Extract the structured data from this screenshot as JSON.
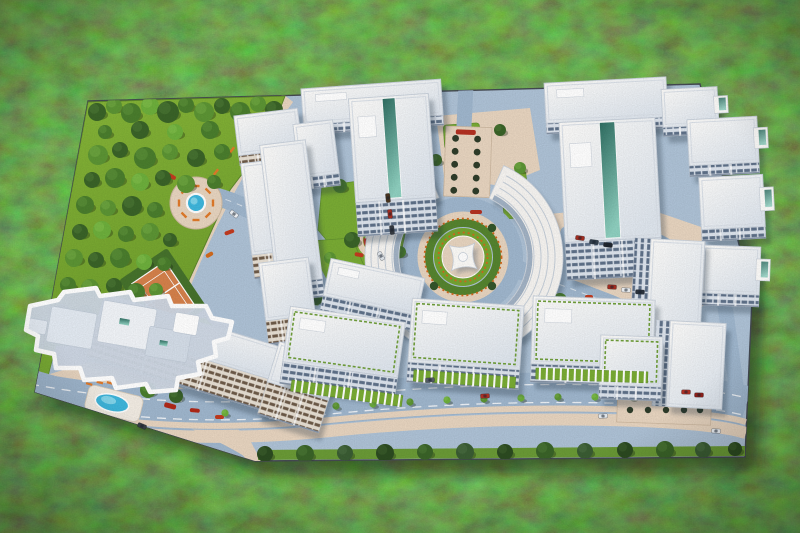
{
  "meta": {
    "title": "Aerial photo of an architectural scale model of a residential complex standing on grass",
    "alt": "Top-down photo of a miniature maquette: white apartment blocks around a star-monument roundabout, park with model trees, tennis court, pools, boulevard with cars; one building outlined in white"
  },
  "palette": {
    "base": "#aec2d6",
    "road": "#9fb6cd",
    "tan": "#e7d4bf",
    "tanDark": "#d9c5ae",
    "turf1": "#86b538",
    "turf2": "#6f9e2c",
    "green": "#79ab34",
    "white": "#f6f4f1",
    "roofEdge": "#c9d1db",
    "pool": "#3fb6dc",
    "orange": "#d2691e",
    "red": "#b33122",
    "edge": "#454a52",
    "treeCols": [
      "#2c4b21",
      "#3a6328",
      "#4a7d2d",
      "#5c9434",
      "#6daf3c",
      "#3a5c33"
    ],
    "treeHi": [
      "#3f6330",
      "#4f7d38",
      "#62973d",
      "#76ad46",
      "#86c14e",
      "#4e7145"
    ]
  },
  "base": {
    "path": "M 88,101 L 700,84 L 752,298 L 745,457 L 255,461 L 35,392 Z"
  },
  "park": {
    "points": "88,102 285,96 268,140 230,190 205,245 180,300 150,335 118,346 43,345",
    "trees": [
      [
        97,
        112,
        9,
        1
      ],
      [
        114,
        106,
        8,
        3
      ],
      [
        131,
        113,
        10,
        2
      ],
      [
        150,
        106,
        9,
        4
      ],
      [
        168,
        112,
        11,
        1
      ],
      [
        186,
        105,
        8,
        2
      ],
      [
        204,
        112,
        10,
        3
      ],
      [
        222,
        106,
        8,
        1
      ],
      [
        240,
        112,
        10,
        2
      ],
      [
        258,
        104,
        8,
        3
      ],
      [
        274,
        110,
        9,
        1
      ],
      [
        105,
        132,
        7,
        2
      ],
      [
        140,
        130,
        9,
        1
      ],
      [
        175,
        132,
        8,
        4
      ],
      [
        210,
        130,
        9,
        2
      ],
      [
        245,
        128,
        8,
        1
      ],
      [
        264,
        132,
        7,
        3
      ],
      [
        98,
        155,
        10,
        3
      ],
      [
        120,
        150,
        8,
        1
      ],
      [
        145,
        158,
        11,
        2
      ],
      [
        170,
        152,
        8,
        3
      ],
      [
        196,
        158,
        9,
        1
      ],
      [
        222,
        152,
        8,
        2
      ],
      [
        246,
        152,
        9,
        4
      ],
      [
        92,
        180,
        8,
        1
      ],
      [
        115,
        178,
        10,
        2
      ],
      [
        140,
        182,
        9,
        4
      ],
      [
        163,
        178,
        8,
        1
      ],
      [
        186,
        184,
        9,
        3
      ],
      [
        214,
        182,
        7,
        2
      ],
      [
        85,
        205,
        9,
        2
      ],
      [
        108,
        208,
        8,
        3
      ],
      [
        132,
        206,
        10,
        1
      ],
      [
        155,
        210,
        8,
        2
      ],
      [
        80,
        232,
        8,
        1
      ],
      [
        102,
        230,
        9,
        4
      ],
      [
        126,
        234,
        8,
        2
      ],
      [
        150,
        232,
        9,
        3
      ],
      [
        170,
        240,
        7,
        1
      ],
      [
        74,
        258,
        9,
        3
      ],
      [
        96,
        260,
        8,
        1
      ],
      [
        120,
        258,
        10,
        2
      ],
      [
        144,
        262,
        8,
        4
      ],
      [
        164,
        264,
        7,
        2
      ],
      [
        68,
        285,
        8,
        2
      ],
      [
        90,
        288,
        9,
        3
      ],
      [
        114,
        286,
        8,
        1
      ],
      [
        136,
        292,
        9,
        2
      ],
      [
        156,
        290,
        7,
        3
      ],
      [
        62,
        312,
        8,
        1
      ],
      [
        84,
        314,
        9,
        2
      ],
      [
        108,
        312,
        8,
        4
      ],
      [
        130,
        318,
        8,
        1
      ],
      [
        58,
        336,
        7,
        3
      ],
      [
        80,
        338,
        8,
        1
      ],
      [
        102,
        336,
        8,
        2
      ],
      [
        122,
        340,
        7,
        3
      ]
    ]
  },
  "roads": {
    "boulevard": "M 30,392 C 140,412 230,414 330,404 C 430,394 540,390 640,394 C 690,396 726,400 746,406",
    "paths": [
      {
        "d": "M 214,196 C 252,206 284,228 304,258 C 322,284 334,320 348,356 L 360,392",
        "w": 18
      },
      {
        "d": "M 514,268 C 548,280 580,292 606,302 C 636,313 658,332 670,356 L 678,386",
        "w": 18
      },
      {
        "d": "M 466,86 L 464,126",
        "w": 15
      },
      {
        "d": "M 414,268 C 396,276 378,294 366,318 C 360,330 356,342 352,352",
        "w": 13
      },
      {
        "d": "M 724,300 C 730,340 734,368 738,402",
        "w": 15
      },
      {
        "d": "M 22,378 C 68,390 118,408 158,426 C 190,440 216,452 236,464",
        "w": 22
      },
      {
        "d": "M 566,232 C 602,224 644,228 670,246 C 692,260 696,284 680,298 C 660,314 618,316 594,306 C 570,296 560,282 562,262 C 563,248 564,240 566,232",
        "w": 11
      }
    ]
  },
  "sidewalks": {
    "cornerTan": "30,380 90,362 150,372 205,400 250,440 262,463 120,463 28,412",
    "courtyardTan": "548,214 640,206 704,228 710,300 686,320 600,326 560,304 544,258",
    "topTan": "436,116 530,108 540,170 500,186 444,176",
    "walk": "M 288,98 C 242,158 208,224 182,290 C 172,314 162,328 150,340"
  },
  "greens": [
    {
      "type": "poly",
      "pts": "322,186 396,176 410,210 400,258 350,268 318,230"
    },
    {
      "type": "poly",
      "pts": "296,242 352,238 368,275 352,308 306,304 288,272"
    },
    {
      "type": "poly",
      "pts": "556,300 598,294 612,318 592,334 558,330"
    },
    {
      "type": "rect",
      "x": 640,
      "y": 326,
      "w": 54,
      "h": 22,
      "rot": 3
    },
    {
      "type": "rect",
      "x": 444,
      "y": 124,
      "w": 36,
      "h": 24,
      "rot": -4
    },
    {
      "type": "rect",
      "x": 502,
      "y": 172,
      "w": 26,
      "h": 46,
      "rot": -6
    },
    {
      "type": "rect",
      "x": 526,
      "y": 206,
      "w": 22,
      "h": 34,
      "rot": -10
    },
    {
      "type": "poly",
      "pts": "43,345 56,345 44,392 35,392"
    },
    {
      "type": "poly",
      "pts": "118,330 205,318 230,345 150,360 95,360"
    }
  ],
  "arcades": [
    {
      "x": 292,
      "y": 380,
      "w": 112,
      "h": 11,
      "rot": 8
    },
    {
      "x": 414,
      "y": 370,
      "w": 102,
      "h": 11,
      "rot": 4
    },
    {
      "x": 536,
      "y": 368,
      "w": 112,
      "h": 11,
      "rot": 2
    }
  ],
  "buildings": [
    {
      "x": 302,
      "y": 84,
      "w": 140,
      "h": 36,
      "rot": -4,
      "fh": 10,
      "p": "fa"
    },
    {
      "x": 545,
      "y": 80,
      "w": 122,
      "h": 40,
      "rot": -3,
      "fh": 11,
      "p": "fa"
    },
    {
      "x": 662,
      "y": 88,
      "w": 56,
      "h": 38,
      "rot": -3,
      "fh": 9,
      "p": "fa",
      "balc": 1
    },
    {
      "x": 236,
      "y": 112,
      "w": 64,
      "h": 40,
      "rot": -7,
      "fh": 10,
      "p": "fb"
    },
    {
      "x": 296,
      "y": 122,
      "w": 40,
      "h": 54,
      "rot": -7,
      "fh": 12,
      "p": "fa"
    },
    {
      "x": 688,
      "y": 118,
      "w": 70,
      "h": 46,
      "rot": -3,
      "fh": 11,
      "p": "fa",
      "balc": 1
    },
    {
      "x": 352,
      "y": 96,
      "w": 80,
      "h": 104,
      "rot": -4,
      "fh": 34,
      "p": "fa",
      "glass": 1
    },
    {
      "x": 562,
      "y": 120,
      "w": 96,
      "h": 120,
      "rot": -3,
      "fh": 38,
      "p": "fa",
      "glass": 1
    },
    {
      "x": 246,
      "y": 160,
      "w": 56,
      "h": 92,
      "rot": -7,
      "fh": 24,
      "p": "fb"
    },
    {
      "x": 268,
      "y": 142,
      "w": 46,
      "h": 140,
      "rot": -7,
      "fh": 18,
      "p": "fa"
    },
    {
      "x": 700,
      "y": 176,
      "w": 64,
      "h": 52,
      "rot": -3,
      "fh": 12,
      "p": "fa",
      "balc": 1
    },
    {
      "x": 702,
      "y": 246,
      "w": 58,
      "h": 48,
      "rot": 2,
      "fh": 12,
      "p": "fa",
      "balc": 1
    },
    {
      "x": 648,
      "y": 240,
      "w": 54,
      "h": 112,
      "rot": 3,
      "fh": 16,
      "p": "fv",
      "fside": "left"
    },
    {
      "x": 262,
      "y": 260,
      "w": 50,
      "h": 58,
      "rot": -7,
      "fh": 24,
      "p": "fb"
    },
    {
      "x": 326,
      "y": 268,
      "w": 96,
      "h": 38,
      "rot": 12,
      "fh": 16,
      "p": "fa"
    },
    {
      "x": 96,
      "y": 322,
      "w": 200,
      "h": 34,
      "rot": 17,
      "fh": 32,
      "p": "fb"
    },
    {
      "x": 272,
      "y": 350,
      "w": 64,
      "h": 42,
      "rot": 17,
      "fh": 34,
      "p": "fb"
    },
    {
      "x": 286,
      "y": 314,
      "w": 116,
      "h": 56,
      "rot": 8,
      "fh": 22,
      "p": "fa",
      "hedge": 1
    },
    {
      "x": 410,
      "y": 302,
      "w": 112,
      "h": 64,
      "rot": 4,
      "fh": 20,
      "p": "fa",
      "hedge": 1
    },
    {
      "x": 532,
      "y": 298,
      "w": 122,
      "h": 68,
      "rot": 2,
      "fh": 18,
      "p": "fa",
      "hedge": 1
    },
    {
      "x": 668,
      "y": 322,
      "w": 56,
      "h": 86,
      "rot": 3,
      "fh": 14,
      "p": "fv",
      "fside": "left"
    },
    {
      "x": 600,
      "y": 336,
      "w": 62,
      "h": 50,
      "rot": 2,
      "fh": 14,
      "p": "fa",
      "hedge": 1
    }
  ],
  "arcBuildings": {
    "cx": 463,
    "cy": 257,
    "items": [
      {
        "a0": 105,
        "a1": 248,
        "r0": 64,
        "r1": 98
      },
      {
        "a0": -66,
        "a1": 56,
        "r0": 64,
        "r1": 100
      }
    ]
  },
  "roundabout": {
    "cx": 463,
    "cy": 257,
    "ringR": 52,
    "ringW": 16,
    "tanR": 41,
    "hedgeR": 34,
    "grassR": 29,
    "plazaR": 21,
    "starRo": 18,
    "starRi": 7
  },
  "highlight": {
    "outline": "M 30,306 L 58,300 L 64,292 L 96,288 L 100,296 L 130,292 L 134,300 L 168,296 L 172,306 L 206,306 L 212,318 L 232,322 L 228,338 L 214,342 L 216,356 L 198,362 L 200,374 L 178,378 L 176,390 L 150,392 L 146,384 L 116,388 L 112,378 L 84,380 L 80,368 L 56,368 L 54,354 L 36,350 L 38,336 L 26,330 Z",
    "roofs": [
      {
        "x": 52,
        "y": 306,
        "w": 46,
        "h": 36,
        "f": "#e3eaf2"
      },
      {
        "x": 104,
        "y": 300,
        "w": 54,
        "h": 42,
        "f": "#f1f4f8"
      },
      {
        "x": 150,
        "y": 326,
        "w": 42,
        "h": 30,
        "f": "#d4dde8"
      },
      {
        "x": 176,
        "y": 312,
        "w": 24,
        "h": 20,
        "f": "#ffffff"
      },
      {
        "x": 30,
        "y": 318,
        "w": 18,
        "h": 14,
        "f": "#e3eaf2"
      }
    ],
    "glassBits": [
      {
        "x": 120,
        "y": 318,
        "w": 10,
        "h": 6
      },
      {
        "x": 160,
        "y": 340,
        "w": 8,
        "h": 5
      }
    ]
  },
  "tennis": {
    "cx": 163,
    "cy": 294,
    "rot": -34,
    "pad": {
      "x": 134,
      "y": 258,
      "w": 58,
      "h": 72
    },
    "court": {
      "x": 143,
      "y": 268,
      "w": 40,
      "h": 56
    }
  },
  "pool": {
    "rot": 14,
    "deck": {
      "x": 86,
      "y": 390,
      "w": 56,
      "h": 26
    },
    "cx": 112,
    "cy": 403,
    "rx": 17,
    "ry": 8.5,
    "loungers": [
      [
        92,
        385
      ],
      [
        102,
        383
      ],
      [
        82,
        389
      ]
    ]
  },
  "plaza": {
    "cx": 196,
    "cy": 203,
    "r": 26,
    "fr": 8,
    "benchR": 17,
    "benches": 8,
    "walkBenches": [
      [
        232,
        150,
        -52
      ],
      [
        250,
        132,
        -52
      ],
      [
        216,
        172,
        -52
      ]
    ]
  },
  "alley": {
    "x": 446,
    "y": 126,
    "w": 46,
    "h": 70,
    "rot": 2,
    "cols": [
      456,
      478
    ],
    "rows": [
      138,
      151,
      164,
      177,
      190
    ],
    "flower": {
      "x": 456,
      "y": 129,
      "w": 20,
      "h": 5
    }
  },
  "playgrounds": [
    {
      "cx": 376,
      "cy": 240,
      "r": 11,
      "dots": [
        "#e06aa0",
        "#4a90d9",
        "#e0b040"
      ]
    },
    {
      "cx": 362,
      "cy": 284,
      "r": 9,
      "dots": [
        "#4a90d9",
        "#e06aa0"
      ]
    }
  ],
  "parking": {
    "lot": {
      "x": 618,
      "y": 384,
      "w": 94,
      "h": 38,
      "rot": 2
    },
    "bushXs": [
      630,
      648,
      666,
      684,
      700
    ],
    "bushYs": [
      394,
      410
    ],
    "courtBushes": [
      [
        570,
        236
      ],
      [
        600,
        252
      ],
      [
        660,
        258
      ],
      [
        690,
        280
      ],
      [
        664,
        300
      ]
    ]
  },
  "flowers": [
    [
      168,
      172,
      10,
      4,
      30,
      "#c23b1f"
    ],
    [
      224,
      232,
      10,
      4,
      -20,
      "#c23b1f"
    ],
    [
      252,
      150,
      8,
      4,
      0,
      "#d2691e"
    ],
    [
      355,
      252,
      9,
      4,
      10,
      "#c23b1f"
    ],
    [
      470,
      210,
      12,
      4,
      0,
      "#b33122"
    ],
    [
      585,
      295,
      8,
      4,
      0,
      "#c23b1f"
    ],
    [
      640,
      318,
      8,
      4,
      0,
      "#d26b1e"
    ],
    [
      205,
      255,
      8,
      4,
      -30,
      "#d26b1e"
    ],
    [
      165,
      402,
      12,
      5,
      15,
      "#b02818"
    ],
    [
      190,
      408,
      10,
      4,
      5,
      "#b02818"
    ],
    [
      215,
      415,
      9,
      4,
      0,
      "#c23b1f"
    ],
    [
      300,
      390,
      8,
      3,
      -6,
      "#d26b1e"
    ],
    [
      500,
      380,
      8,
      3,
      0,
      "#c23b1f"
    ],
    [
      660,
      384,
      8,
      3,
      2,
      "#d26b1e"
    ]
  ],
  "streetTrees": [
    [
      265,
      454,
      8,
      0
    ],
    [
      305,
      454,
      9,
      1
    ],
    [
      345,
      453,
      8,
      5
    ],
    [
      385,
      453,
      9,
      0
    ],
    [
      425,
      452,
      8,
      1
    ],
    [
      465,
      452,
      9,
      5
    ],
    [
      505,
      452,
      8,
      0
    ],
    [
      545,
      451,
      9,
      1
    ],
    [
      585,
      451,
      8,
      5
    ],
    [
      625,
      450,
      8,
      0
    ],
    [
      665,
      450,
      9,
      1
    ],
    [
      703,
      450,
      8,
      5
    ],
    [
      735,
      449,
      7,
      0
    ]
  ],
  "medianBushes": [
    [
      225,
      413
    ],
    [
      262,
      411
    ],
    [
      299,
      409
    ],
    [
      336,
      406
    ],
    [
      373,
      404
    ],
    [
      410,
      402
    ],
    [
      447,
      400
    ],
    [
      484,
      399
    ],
    [
      521,
      398
    ],
    [
      558,
      397
    ],
    [
      595,
      397
    ],
    [
      632,
      397
    ],
    [
      669,
      398
    ],
    [
      706,
      401
    ]
  ],
  "scatterTrees": [
    [
      340,
      186,
      7,
      2
    ],
    [
      352,
      240,
      8,
      1
    ],
    [
      330,
      258,
      6,
      3
    ],
    [
      305,
      252,
      7,
      2
    ],
    [
      316,
      298,
      7,
      1
    ],
    [
      345,
      300,
      6,
      4
    ],
    [
      400,
      252,
      6,
      2
    ],
    [
      436,
      160,
      6,
      1
    ],
    [
      520,
      168,
      6,
      3
    ],
    [
      560,
      300,
      7,
      2
    ],
    [
      585,
      316,
      6,
      1
    ],
    [
      616,
      332,
      7,
      3
    ],
    [
      648,
      338,
      6,
      2
    ],
    [
      575,
      252,
      6,
      4
    ],
    [
      410,
      118,
      6,
      2
    ],
    [
      500,
      130,
      6,
      1
    ],
    [
      148,
      390,
      8,
      2
    ],
    [
      176,
      396,
      7,
      1
    ]
  ],
  "cars": [
    [
      485,
      396,
      -4,
      "#b03227"
    ],
    [
      603,
      416,
      -3,
      "#e8edf2"
    ],
    [
      142,
      426,
      22,
      "#3a4148"
    ],
    [
      716,
      431,
      3,
      "#e8edf2"
    ],
    [
      430,
      380,
      -4,
      "#555c66"
    ],
    [
      234,
      214,
      38,
      "#eef1f5"
    ],
    [
      388,
      198,
      84,
      "#4a351f"
    ],
    [
      390,
      214,
      84,
      "#a62e22"
    ],
    [
      392,
      230,
      84,
      "#363b42"
    ],
    [
      381,
      256,
      60,
      "#dfe4ea"
    ],
    [
      580,
      238,
      8,
      "#a62e22"
    ],
    [
      594,
      242,
      8,
      "#33404e"
    ],
    [
      608,
      245,
      8,
      "#20262e"
    ],
    [
      612,
      287,
      4,
      "#a62e22"
    ],
    [
      626,
      290,
      4,
      "#eef1f4"
    ],
    [
      640,
      292,
      4,
      "#2c343e"
    ],
    [
      686,
      392,
      2,
      "#b03227"
    ],
    [
      699,
      395,
      2,
      "#8f201a"
    ]
  ],
  "crosswalk": {
    "xs": [
      460,
      468,
      476,
      484,
      492
    ],
    "y": 372,
    "w": 3.5,
    "h": 10,
    "rot": 3
  }
}
